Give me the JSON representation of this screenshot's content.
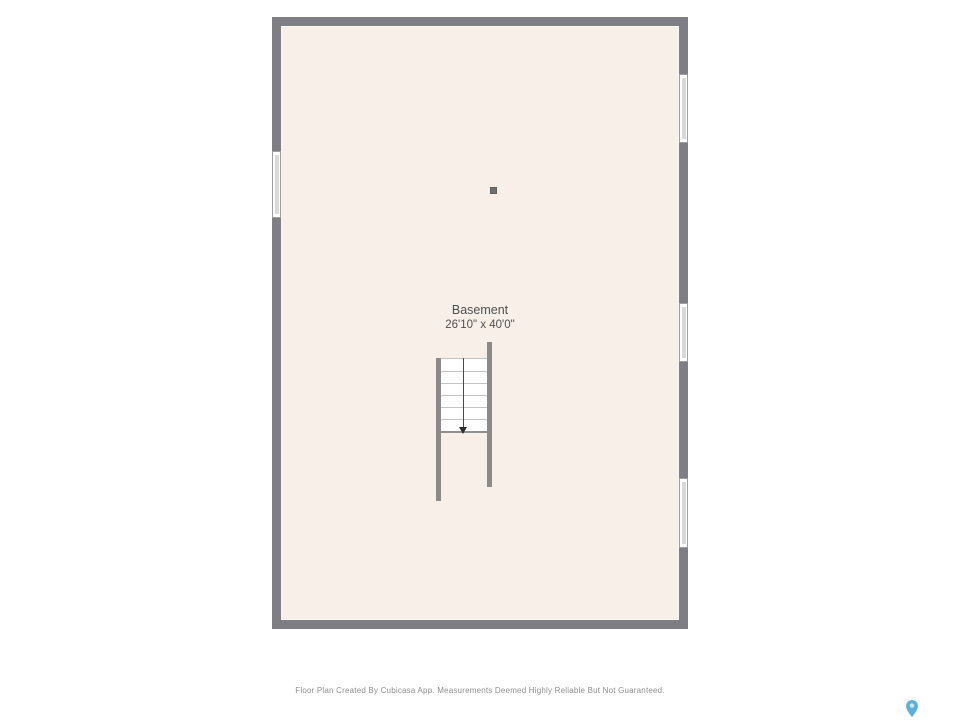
{
  "room": {
    "name": "Basement",
    "dimensions": "26'10\" x 40'0\""
  },
  "stairs": {
    "direction": "down",
    "tread_count": 6
  },
  "features": {
    "windows": [
      "window-left",
      "window-right-top",
      "window-right-middle",
      "window-right-bottom"
    ],
    "column": "support-column"
  },
  "colors": {
    "wall": "#7f7e84",
    "floor": "#f8f0e8",
    "logo_blue": "#5fb0d8"
  },
  "footer": {
    "disclaimer": "Floor Plan Created By Cubicasa App. Measurements Deemed Highly Reliable But Not Guaranteed."
  }
}
